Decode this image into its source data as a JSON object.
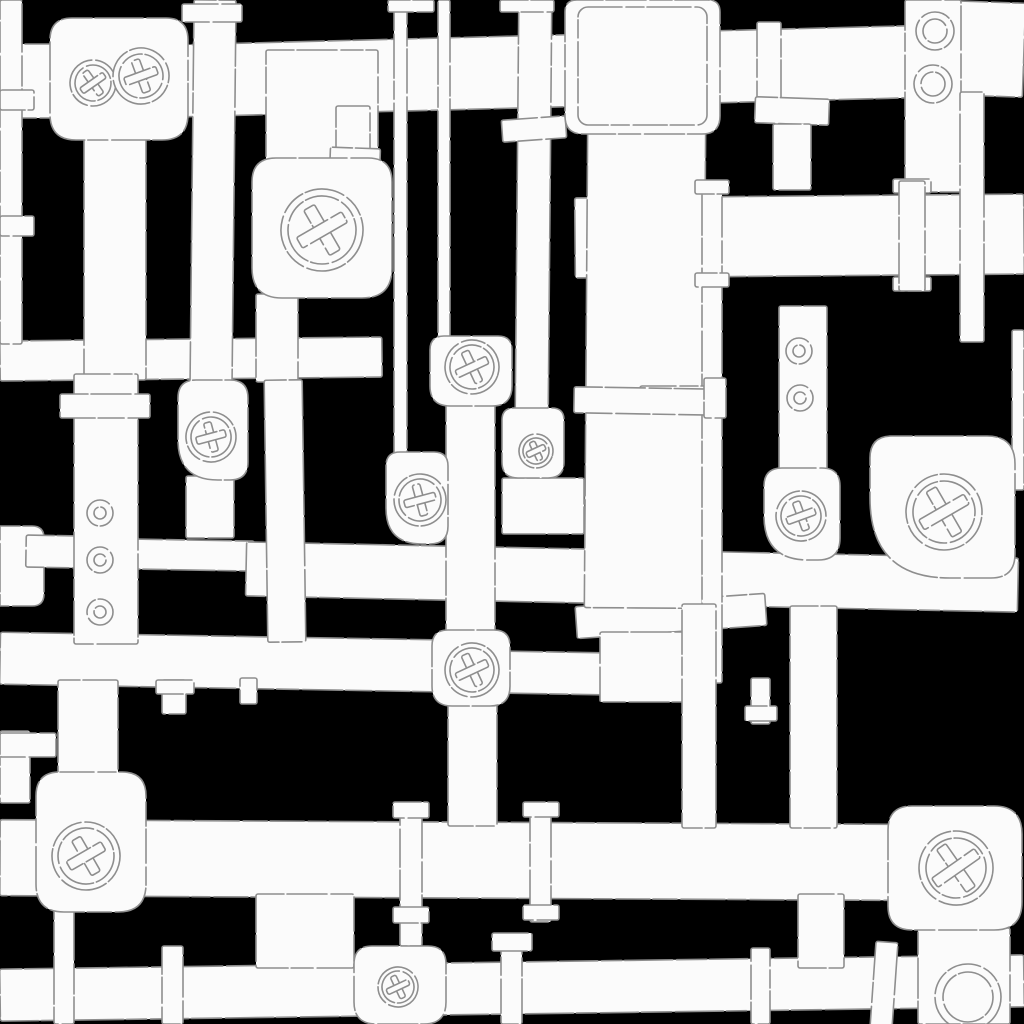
{
  "canvas": {
    "width": 1024,
    "height": 1024
  },
  "palette": {
    "background": "#000000",
    "pipe_fill": "#fbfbfb",
    "outline": "#8e8e8e"
  },
  "shapes": [
    {
      "k": "r",
      "n": "pipe-top-band",
      "p": [
        118,
        36,
        800,
        72,
        -1.5
      ]
    },
    {
      "k": "r",
      "n": "pipe-top-right",
      "p": [
        950,
        2,
        74,
        94,
        2
      ]
    },
    {
      "k": "r",
      "n": "pipe-left-top-stub",
      "p": [
        0,
        44,
        58,
        74
      ]
    },
    {
      "k": "r",
      "n": "pipe-mid-left-band",
      "p": [
        0,
        339,
        382,
        40,
        -0.6
      ]
    },
    {
      "k": "r",
      "n": "pipe-right-mid-band",
      "p": [
        575,
        196,
        449,
        80,
        -0.5
      ]
    },
    {
      "k": "b",
      "n": "pipe-left-elbow",
      "p": [
        0,
        526,
        44,
        80,
        0,
        12,
        12,
        0
      ]
    },
    {
      "k": "r",
      "n": "pipe-h5-left",
      "p": [
        26,
        536,
        112,
        32,
        1
      ]
    },
    {
      "k": "r",
      "n": "pipe-h5-seg",
      "p": [
        126,
        540,
        128,
        30,
        1
      ]
    },
    {
      "k": "r",
      "n": "pipe-center-band",
      "p": [
        246,
        550,
        772,
        54,
        1.2
      ]
    },
    {
      "k": "r",
      "n": "pipe-h6-left-band",
      "p": [
        0,
        636,
        434,
        52,
        1
      ]
    },
    {
      "k": "r",
      "n": "pipe-h6-stub",
      "p": [
        506,
        652,
        98,
        42,
        1
      ]
    },
    {
      "k": "r",
      "n": "pipe-h6-slant",
      "p": [
        576,
        600,
        190,
        32,
        -4
      ]
    },
    {
      "k": "r",
      "n": "pipe-junction-right",
      "p": [
        600,
        632,
        84,
        70
      ]
    },
    {
      "k": "r",
      "n": "pipe-bottom-band",
      "p": [
        0,
        822,
        892,
        76,
        0.3
      ]
    },
    {
      "k": "r",
      "n": "pipe-base-band",
      "p": [
        0,
        962,
        1024,
        52,
        -0.8
      ]
    },
    {
      "k": "r",
      "n": "pipe-conn-left",
      "p": [
        256,
        894,
        98,
        74
      ]
    },
    {
      "k": "r",
      "n": "pipe-conn-right",
      "p": [
        798,
        894,
        46,
        74
      ]
    },
    {
      "k": "r",
      "n": "pipe-left-edge",
      "p": [
        0,
        0,
        22,
        344
      ]
    },
    {
      "k": "r",
      "n": "pipe-left-upper",
      "p": [
        84,
        126,
        62,
        254
      ]
    },
    {
      "k": "r",
      "n": "pipe-left-lower",
      "p": [
        74,
        374,
        64,
        270
      ]
    },
    {
      "k": "r",
      "n": "pipe-v194",
      "p": [
        192,
        0,
        42,
        392,
        0.6
      ]
    },
    {
      "k": "r",
      "n": "pipe-b2-feed",
      "p": [
        266,
        50,
        112,
        116
      ]
    },
    {
      "k": "r",
      "n": "pipe-b2-down",
      "p": [
        256,
        294,
        42,
        88
      ]
    },
    {
      "k": "r",
      "n": "pipe-v282",
      "p": [
        266,
        380,
        38,
        262,
        -0.8
      ]
    },
    {
      "k": "r",
      "n": "pipe-b8-down",
      "p": [
        186,
        476,
        48,
        62
      ]
    },
    {
      "k": "r",
      "n": "pipe-v396",
      "p": [
        394,
        0,
        13,
        460
      ]
    },
    {
      "k": "r",
      "n": "pipe-v442",
      "p": [
        438,
        0,
        12,
        344
      ]
    },
    {
      "k": "r",
      "n": "pipe-v520",
      "p": [
        517,
        0,
        33,
        414,
        0.5
      ]
    },
    {
      "k": "r",
      "n": "pipe-stub352",
      "p": [
        336,
        106,
        34,
        46
      ]
    },
    {
      "k": "r",
      "n": "pipe-center-wide",
      "p": [
        586,
        126,
        118,
        482,
        0.4
      ]
    },
    {
      "k": "r",
      "n": "pipe-v710-thin",
      "p": [
        702,
        185,
        20,
        498
      ]
    },
    {
      "k": "r",
      "n": "pipe-v700-wide",
      "p": [
        682,
        604,
        34,
        224
      ]
    },
    {
      "k": "r",
      "n": "pipe-rivet-v",
      "p": [
        779,
        306,
        48,
        168
      ]
    },
    {
      "k": "r",
      "n": "pipe-v800-down",
      "p": [
        790,
        606,
        47,
        222
      ]
    },
    {
      "k": "r",
      "n": "pipe-ring-v",
      "p": [
        905,
        0,
        56,
        192
      ]
    },
    {
      "k": "r",
      "n": "pipe-v970",
      "p": [
        960,
        92,
        24,
        250
      ]
    },
    {
      "k": "r",
      "n": "pipe-right-sliver",
      "p": [
        1012,
        330,
        12,
        160
      ]
    },
    {
      "k": "r",
      "n": "pipe-h4-stub",
      "p": [
        640,
        386,
        84,
        26
      ]
    },
    {
      "k": "r",
      "n": "pipe-junction-mid",
      "p": [
        502,
        478,
        82,
        56
      ]
    },
    {
      "k": "r",
      "n": "pipe-center-v",
      "p": [
        446,
        400,
        49,
        236
      ]
    },
    {
      "k": "r",
      "n": "pipe-v14",
      "p": [
        448,
        702,
        49,
        124
      ]
    },
    {
      "k": "r",
      "n": "pipe-b11-feed",
      "p": [
        58,
        680,
        60,
        96
      ]
    },
    {
      "k": "r",
      "n": "pipe-lstub-v",
      "p": [
        0,
        731,
        30,
        72
      ]
    },
    {
      "k": "r",
      "n": "pipe-lstub-h",
      "p": [
        0,
        733,
        56,
        24
      ]
    },
    {
      "k": "r",
      "n": "pipe-stub162",
      "p": [
        162,
        680,
        24,
        34
      ]
    },
    {
      "k": "r",
      "n": "pipe-stub248",
      "p": [
        240,
        678,
        17,
        26
      ]
    },
    {
      "k": "r",
      "n": "pipe-stub760",
      "p": [
        751,
        678,
        19,
        46
      ]
    },
    {
      "k": "r",
      "n": "pipe-f400",
      "p": [
        400,
        806,
        22,
        140
      ]
    },
    {
      "k": "r",
      "n": "pipe-f530",
      "p": [
        530,
        806,
        21,
        116
      ]
    },
    {
      "k": "r",
      "n": "pipe-f500",
      "p": [
        501,
        938,
        21,
        86
      ]
    },
    {
      "k": "r",
      "n": "pipe-v55",
      "p": [
        54,
        906,
        20,
        118
      ]
    },
    {
      "k": "r",
      "n": "pipe-v165",
      "p": [
        162,
        946,
        21,
        78
      ]
    },
    {
      "k": "r",
      "n": "pipe-v750",
      "p": [
        751,
        948,
        19,
        76
      ]
    },
    {
      "k": "r",
      "n": "pipe-v880",
      "p": [
        873,
        942,
        22,
        86,
        4
      ]
    },
    {
      "k": "r",
      "n": "pipe-ring-br",
      "p": [
        918,
        928,
        92,
        96
      ]
    },
    {
      "k": "r",
      "n": "flange",
      "p": [
        182,
        4,
        60,
        18
      ]
    },
    {
      "k": "r",
      "n": "flange",
      "p": [
        388,
        0,
        46,
        12
      ]
    },
    {
      "k": "r",
      "n": "flange",
      "p": [
        500,
        0,
        54,
        12
      ]
    },
    {
      "k": "r",
      "n": "flange",
      "p": [
        502,
        118,
        64,
        22,
        -4
      ]
    },
    {
      "k": "r",
      "n": "flange",
      "p": [
        330,
        148,
        50,
        26,
        2
      ]
    },
    {
      "k": "r",
      "n": "flange",
      "p": [
        60,
        394,
        90,
        24
      ]
    },
    {
      "k": "r",
      "n": "flange-collar",
      "p": [
        757,
        22,
        24,
        92
      ]
    },
    {
      "k": "r",
      "n": "flange",
      "p": [
        755,
        98,
        74,
        26,
        2
      ]
    },
    {
      "k": "r",
      "n": "pipe-t-stub",
      "p": [
        773,
        124,
        38,
        66
      ]
    },
    {
      "k": "r",
      "n": "flange",
      "p": [
        893,
        179,
        38,
        14
      ]
    },
    {
      "k": "r",
      "n": "flange",
      "p": [
        893,
        277,
        38,
        14
      ]
    },
    {
      "k": "r",
      "n": "pipe-collar",
      "p": [
        899,
        181,
        26,
        110
      ]
    },
    {
      "k": "r",
      "n": "flange",
      "p": [
        695,
        180,
        34,
        14
      ]
    },
    {
      "k": "r",
      "n": "flange",
      "p": [
        695,
        273,
        34,
        14
      ]
    },
    {
      "k": "r",
      "n": "flange-wide",
      "p": [
        574,
        388,
        144,
        26,
        1
      ]
    },
    {
      "k": "r",
      "n": "flange",
      "p": [
        0,
        90,
        34,
        20
      ]
    },
    {
      "k": "r",
      "n": "flange",
      "p": [
        0,
        216,
        34,
        20
      ]
    },
    {
      "k": "r",
      "n": "flange",
      "p": [
        704,
        378,
        22,
        40
      ]
    },
    {
      "k": "r",
      "n": "flange",
      "p": [
        156,
        680,
        38,
        14
      ]
    },
    {
      "k": "r",
      "n": "flange",
      "p": [
        745,
        706,
        32,
        15
      ]
    },
    {
      "k": "r",
      "n": "flange",
      "p": [
        393,
        802,
        36,
        16
      ]
    },
    {
      "k": "r",
      "n": "flange",
      "p": [
        393,
        907,
        36,
        16
      ]
    },
    {
      "k": "r",
      "n": "flange",
      "p": [
        523,
        802,
        36,
        15
      ]
    },
    {
      "k": "r",
      "n": "flange",
      "p": [
        523,
        905,
        36,
        15
      ]
    },
    {
      "k": "r",
      "n": "flange",
      "p": [
        492,
        933,
        40,
        18
      ]
    },
    {
      "k": "b",
      "n": "valve-box-double",
      "p": [
        50,
        18,
        138,
        122,
        22,
        22,
        26,
        26
      ]
    },
    {
      "k": "b",
      "n": "fitting-box-top",
      "p": [
        565,
        0,
        155,
        134,
        12,
        12,
        18,
        18
      ]
    },
    {
      "k": "o",
      "n": "fitting-box-inner",
      "p": [
        578,
        7,
        129,
        118,
        10
      ]
    },
    {
      "k": "b",
      "n": "valve-box-upper",
      "p": [
        252,
        158,
        140,
        140,
        24,
        24,
        30,
        30
      ]
    },
    {
      "k": "b",
      "n": "valve-box-c1",
      "p": [
        430,
        336,
        82,
        70,
        14,
        14,
        20,
        20
      ]
    },
    {
      "k": "b",
      "n": "valve-box-small",
      "p": [
        502,
        408,
        62,
        70,
        12,
        12,
        16,
        16
      ]
    },
    {
      "k": "b",
      "n": "valve-box-c2",
      "p": [
        386,
        452,
        62,
        92,
        14,
        14,
        18,
        36
      ]
    },
    {
      "k": "b",
      "n": "valve-box-left-elbow",
      "p": [
        178,
        380,
        70,
        100,
        18,
        18,
        18,
        40
      ]
    },
    {
      "k": "b",
      "n": "valve-box-right-elbow",
      "p": [
        764,
        468,
        76,
        92,
        18,
        18,
        22,
        44
      ]
    },
    {
      "k": "b",
      "n": "valve-box-big-elbow",
      "p": [
        870,
        436,
        145,
        142,
        22,
        28,
        24,
        80
      ]
    },
    {
      "k": "b",
      "n": "valve-box-c3",
      "p": [
        432,
        630,
        78,
        76,
        16,
        16,
        20,
        20
      ]
    },
    {
      "k": "b",
      "n": "valve-box-bottom-left",
      "p": [
        36,
        772,
        110,
        140,
        24,
        24,
        28,
        28
      ]
    },
    {
      "k": "b",
      "n": "valve-box-bottom-right",
      "p": [
        888,
        806,
        134,
        124,
        24,
        28,
        28,
        24
      ]
    },
    {
      "k": "b",
      "n": "valve-box-bottom-mid",
      "p": [
        354,
        946,
        92,
        78,
        18,
        18,
        22,
        22
      ]
    },
    {
      "k": "w",
      "n": "handwheel",
      "p": [
        93,
        83,
        23,
        18,
        14,
        10
      ]
    },
    {
      "k": "w",
      "n": "handwheel",
      "p": [
        141,
        76,
        28,
        22,
        17,
        25
      ]
    },
    {
      "k": "w",
      "n": "handwheel",
      "p": [
        322,
        230,
        41,
        34,
        26,
        15
      ]
    },
    {
      "k": "w",
      "n": "handwheel",
      "p": [
        472,
        367,
        27,
        22,
        17,
        20
      ]
    },
    {
      "k": "w",
      "n": "handwheel",
      "p": [
        536,
        451,
        17,
        13,
        10,
        20
      ]
    },
    {
      "k": "w",
      "n": "handwheel",
      "p": [
        420,
        500,
        26,
        21,
        16,
        30
      ]
    },
    {
      "k": "w",
      "n": "handwheel",
      "p": [
        211,
        437,
        25,
        20,
        15,
        30
      ]
    },
    {
      "k": "w",
      "n": "handwheel",
      "p": [
        801,
        516,
        25,
        20,
        15,
        25
      ]
    },
    {
      "k": "w",
      "n": "handwheel",
      "p": [
        944,
        512,
        38,
        31,
        26,
        15
      ]
    },
    {
      "k": "w",
      "n": "handwheel",
      "p": [
        472,
        670,
        27,
        22,
        17,
        20
      ]
    },
    {
      "k": "w",
      "n": "handwheel",
      "p": [
        86,
        856,
        34,
        28,
        20,
        15
      ]
    },
    {
      "k": "w",
      "n": "handwheel",
      "p": [
        956,
        868,
        37,
        30,
        26,
        10
      ]
    },
    {
      "k": "w",
      "n": "handwheel",
      "p": [
        398,
        987,
        20,
        16,
        12,
        20
      ]
    },
    {
      "k": "g",
      "n": "pipe-ring",
      "p": [
        935,
        31,
        19,
        12
      ]
    },
    {
      "k": "g",
      "n": "pipe-ring",
      "p": [
        933,
        84,
        19,
        12
      ]
    },
    {
      "k": "g",
      "n": "pipe-ring",
      "p": [
        968,
        997,
        33,
        25
      ]
    },
    {
      "k": "v",
      "n": "rivet",
      "p": [
        100,
        513,
        13,
        6
      ]
    },
    {
      "k": "v",
      "n": "rivet",
      "p": [
        100,
        560,
        13,
        6
      ]
    },
    {
      "k": "v",
      "n": "rivet",
      "p": [
        100,
        612,
        13,
        6
      ]
    },
    {
      "k": "v",
      "n": "rivet",
      "p": [
        799,
        351,
        13,
        6
      ]
    },
    {
      "k": "v",
      "n": "rivet",
      "p": [
        800,
        398,
        13,
        6
      ]
    }
  ]
}
